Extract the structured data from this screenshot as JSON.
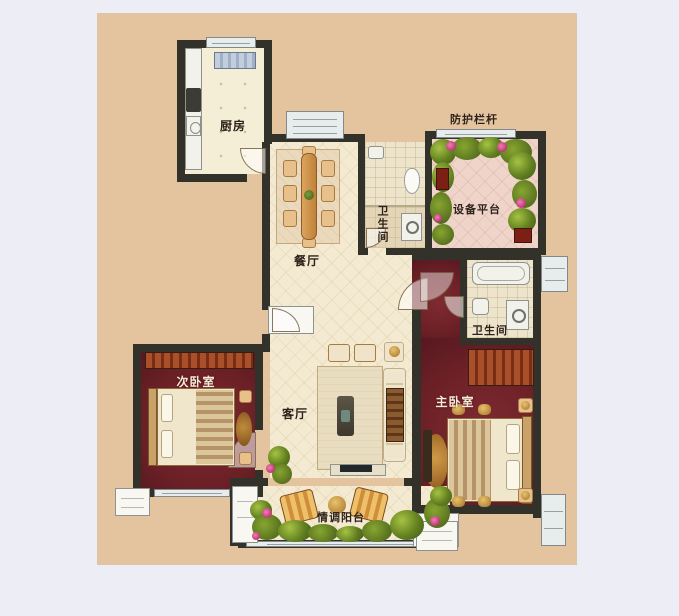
{
  "plan": {
    "type": "floorplan",
    "labels": {
      "kitchen": "厨房",
      "railing": "防护栏杆",
      "equipment_platform": "设备平台",
      "bath_top": "卫生间",
      "dining": "餐厅",
      "bath_master": "卫生间",
      "bedroom_second": "次卧室",
      "living": "客厅",
      "bedroom_master": "主卧室",
      "balcony": "情调阳台"
    },
    "colors": {
      "page_bg": "#ededf6",
      "canvas_bg": "#e4c49e",
      "wall": "#32312a",
      "floor_cream": "#f3ead1",
      "floor_pink": "#efd4c9",
      "floor_maroon": "#6d2127",
      "window_glass": "#e7eced",
      "label_ink": "#2e2118"
    }
  }
}
